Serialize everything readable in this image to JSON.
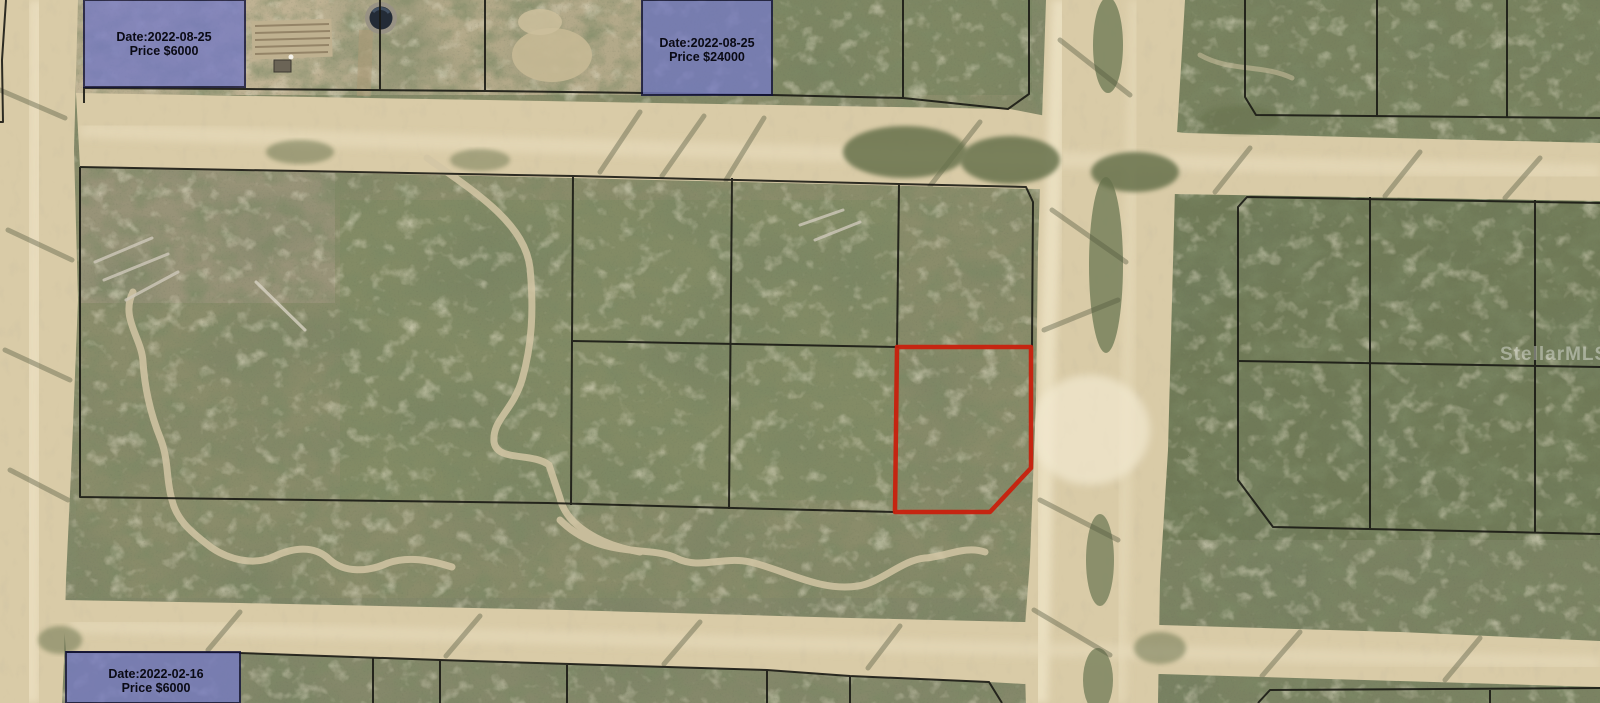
{
  "map": {
    "watermark": "StellarMLS",
    "sold_parcels": [
      {
        "date_line": "Date:2022-08-25",
        "price_line": "Price $6000"
      },
      {
        "date_line": "Date:2022-08-25",
        "price_line": "Price $24000"
      },
      {
        "date_line": "Date:2022-02-16",
        "price_line": "Price $6000"
      }
    ],
    "colors": {
      "sold_fill": "#767bc2",
      "sold_border": "#10103a",
      "boundary": "#1a1a14",
      "subject": "#c8200d",
      "road": "#d9cba7",
      "label_text": "#0a0a14",
      "watermark_color": "#ffffff"
    }
  }
}
